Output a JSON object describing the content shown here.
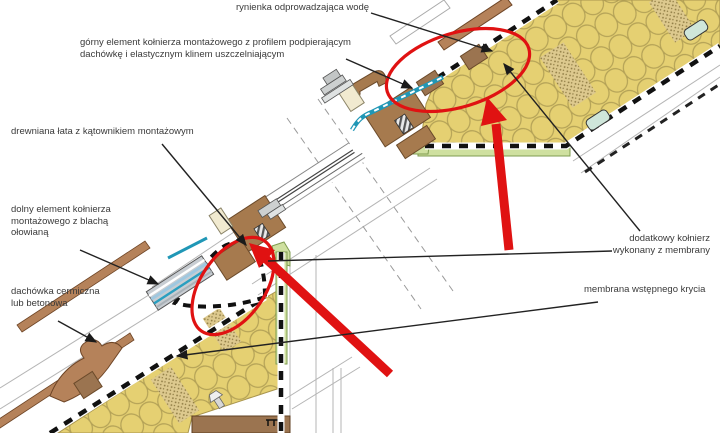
{
  "diagram": {
    "type": "roof-window installation cross-section (technical construction detail)",
    "language": "pl",
    "labels": {
      "rynienka": "rynienka odprowadzająca wodę",
      "gorny": "górny element kołnierza montażowego z profilem podpierającym\ndachówkę i elastycznym klinem uszczelniającym",
      "drewniana": "drewniana łata z kątownikiem montażowym",
      "dolny": "dolny element kołnierza\nmontażowego z blachą\nołowianą",
      "dachowka": "dachówka cermiczna\nlub betonowa",
      "dodatkowy": "dodatkowy kołnierz\nwykonany z membrany",
      "membrana": "membrana wstępnego krycia"
    },
    "annotations": {
      "highlight_color": "#e01212",
      "ellipse_count": 2,
      "arrow_count": 2,
      "ellipses": [
        "top flashing / gutter detail",
        "bottom flashing / membrane collar detail"
      ]
    },
    "colors": {
      "insulation": "#e5d072",
      "insulation_loops": "#b3a156",
      "wood": "#a67a4e",
      "wood_dark": "#6b4a2a",
      "tile": "#b5825a",
      "membrane_dash": "#111111",
      "gutter_teal": "#2097b6",
      "lead_blue": "#9fc8e0",
      "lining_green": "#cfe0a0",
      "metal_grey": "#ccd0d0",
      "leader_line": "#222222",
      "text": "#3a3a3a"
    }
  }
}
